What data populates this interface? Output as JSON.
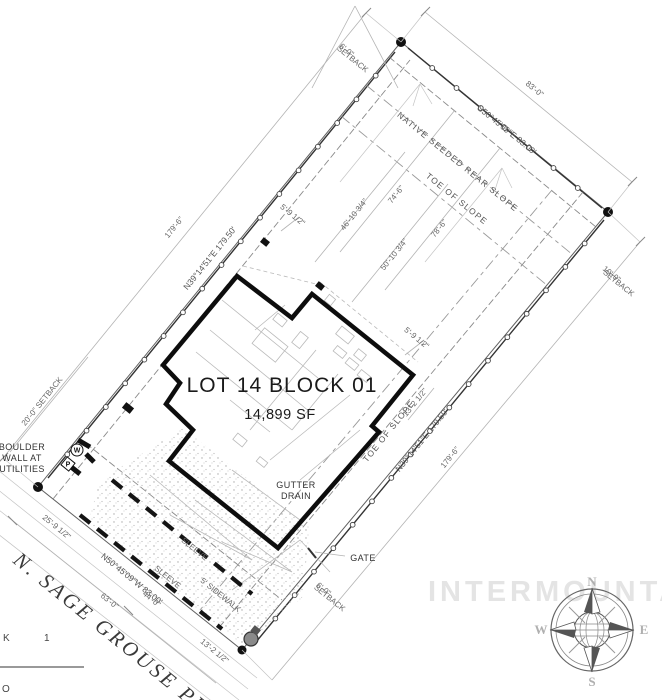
{
  "drawing": {
    "lot_title": "LOT 14 BLOCK 01",
    "lot_area": "14,899 SF",
    "street_name": "N. SAGE GROUSE PL.",
    "watermark": "INTERMOUNTAIN"
  },
  "bearings": {
    "nw_side": "N39°14'51\"E  179.50'",
    "se_side": "N39°14'51\"E  179.50'",
    "ne_side": "S50°45'09\"E  83.00'",
    "street_side": "N50°45'09\"W  83.00'"
  },
  "dimensions": {
    "nw_overall": "179'-6\"",
    "se_overall": "179'-6\"",
    "ne_overall": "83'-0\"",
    "street_63": "63'-0\"",
    "street_44": "44'-0\"",
    "street_25": "25'-9 1/2\"",
    "street_13": "13'-2 1/2\"",
    "side_13": "13'-2 1/2\"",
    "depth_74": "74'-6\"",
    "depth_78": "78'-6\"",
    "depth_46": "46'-10 3/4\"",
    "depth_50": "50'-10 3/4\"",
    "offset_5_top": "5'-9 1/2\"",
    "offset_5_right": "5'-9 1/2\""
  },
  "setbacks": {
    "ne_value": "6'-0\"",
    "ne_word": "SETBACK",
    "street": "20'-0\" SETBACK",
    "se_value": "10'-0\"",
    "se_word": "SETBACK",
    "south_value": "6'-0\"",
    "south_word": "SETBACK"
  },
  "site_labels": {
    "native_slope": "NATIVE SEEDED REAR SLOPE",
    "toe_of_slope_top": "TOE OF SLOPE",
    "toe_of_slope_side": "TOE OF SLOPE",
    "gutter_line1": "GUTTER",
    "gutter_line2": "DRAIN",
    "boulder_line1": "BOULDER",
    "boulder_line2": "WALL AT",
    "boulder_line3": "UTILITIES",
    "gate": "GATE",
    "sleeve_upper": "SLEEVE",
    "sleeve_lower": "SLEEVE",
    "sidewalk": "5' SIDEWALK",
    "water_meter": "W",
    "power_pedestal": "P"
  },
  "compass": {
    "north": "N",
    "south": "S",
    "east": "E",
    "west": "W"
  },
  "sheet_edge": {
    "text_k": "K",
    "text_1": "1",
    "text_o": "O"
  }
}
